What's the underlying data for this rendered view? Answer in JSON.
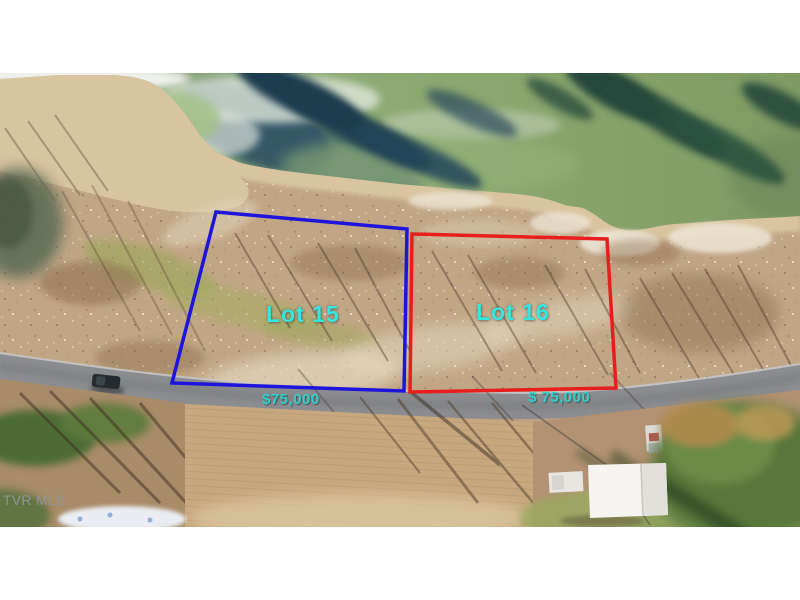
{
  "photo": {
    "watermark": "TVR MLS"
  },
  "lots": [
    {
      "label": "Lot 15",
      "price": "$75,000",
      "outline_color": "#1f14dc",
      "label_color": "#35e6df"
    },
    {
      "label": "Lot 16",
      "price": "$ 75,000",
      "outline_color": "#e81d1d",
      "label_color": "#35e6df"
    }
  ],
  "colors": {
    "letterbox": "#ffffff",
    "water_green": "#8fab74",
    "deep_water": "#2b4d60",
    "sand": "#d9c6a0",
    "scrub": "#c1a685",
    "road": "#8b8c8f",
    "price_text": "#2fd3d0",
    "watermark_text": "#91959a"
  }
}
